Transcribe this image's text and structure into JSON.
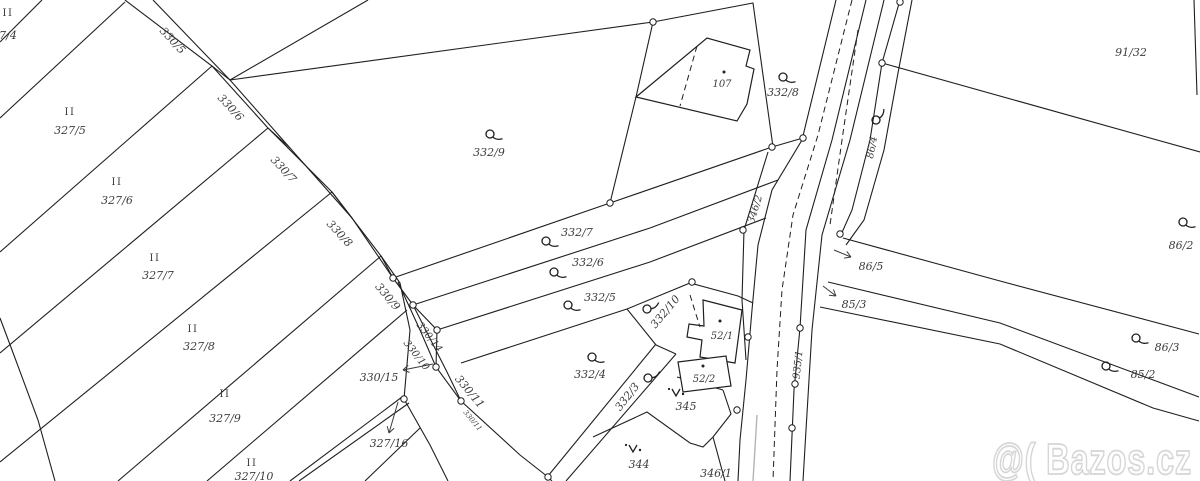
{
  "watermark": {
    "text": "@( Bazos.cz"
  },
  "map": {
    "bg": "#ffffff",
    "line_color": "#1f1f1f",
    "label_color": "#3c3c3c",
    "gray_line_color": "#b3b3b3",
    "watermark_color": "#d6d6d6",
    "lines": [
      [
        [
          42,
          0
        ],
        [
          0,
          42
        ]
      ],
      [
        [
          0,
          118
        ],
        [
          125,
          2
        ]
      ],
      [
        [
          0,
          252
        ],
        [
          212,
          66
        ]
      ],
      [
        [
          0,
          353
        ],
        [
          268,
          128
        ]
      ],
      [
        [
          0,
          462
        ],
        [
          332,
          192
        ]
      ],
      [
        [
          118,
          481
        ],
        [
          381,
          256
        ]
      ],
      [
        [
          207,
          481
        ],
        [
          407,
          310
        ]
      ],
      [
        [
          290,
          481
        ],
        [
          402,
          397
        ]
      ],
      [
        [
          299,
          481
        ],
        [
          409,
          403
        ]
      ],
      [
        [
          365,
          481
        ],
        [
          420,
          428
        ]
      ],
      [
        [
          0,
          318
        ],
        [
          12,
          350
        ],
        [
          38,
          420
        ],
        [
          55,
          481
        ]
      ],
      [
        [
          125,
          0
        ],
        [
          212,
          66
        ],
        [
          268,
          128
        ],
        [
          332,
          192
        ],
        [
          381,
          256
        ],
        [
          400,
          283
        ],
        [
          410,
          330
        ],
        [
          404,
          399
        ],
        [
          430,
          445
        ],
        [
          448,
          481
        ]
      ],
      [
        [
          153,
          0
        ],
        [
          230,
          80
        ],
        [
          290,
          148
        ],
        [
          352,
          218
        ],
        [
          393,
          278
        ],
        [
          413,
          305
        ],
        [
          437,
          330
        ],
        [
          436,
          367
        ],
        [
          461,
          401
        ],
        [
          520,
          455
        ],
        [
          548,
          477
        ],
        [
          552,
          481
        ]
      ],
      [
        [
          212,
          66
        ],
        [
          230,
          80
        ]
      ],
      [
        [
          268,
          128
        ],
        [
          290,
          148
        ]
      ],
      [
        [
          332,
          192
        ],
        [
          352,
          218
        ]
      ],
      [
        [
          381,
          256
        ],
        [
          393,
          278
        ]
      ],
      [
        [
          398,
          282
        ],
        [
          420,
          330
        ],
        [
          436,
          367
        ]
      ],
      [
        [
          413,
          305
        ],
        [
          447,
          372
        ],
        [
          461,
          401
        ]
      ],
      [
        [
          230,
          80
        ],
        [
          368,
          0
        ]
      ],
      [
        [
          230,
          80
        ],
        [
          653,
          22
        ]
      ],
      [
        [
          653,
          22
        ],
        [
          753,
          3
        ],
        [
          773,
          147
        ]
      ],
      [
        [
          653,
          22
        ],
        [
          636,
          97
        ],
        [
          610,
          203
        ]
      ],
      [
        [
          393,
          278
        ],
        [
          610,
          203
        ],
        [
          772,
          147
        ],
        [
          803,
          138
        ]
      ],
      [
        [
          413,
          305
        ],
        [
          650,
          228
        ],
        [
          778,
          180
        ]
      ],
      [
        [
          437,
          330
        ],
        [
          650,
          262
        ],
        [
          766,
          218
        ]
      ],
      [
        [
          461,
          363
        ],
        [
          627,
          309
        ],
        [
          690,
          283
        ],
        [
          738,
          296
        ],
        [
          753,
          303
        ]
      ],
      [
        [
          627,
          309
        ],
        [
          656,
          345
        ]
      ],
      [
        [
          656,
          345
        ],
        [
          676,
          354
        ]
      ],
      [
        [
          548,
          476
        ],
        [
          656,
          344
        ]
      ],
      [
        [
          566,
          481
        ],
        [
          676,
          354
        ]
      ],
      [
        [
          677,
          377
        ],
        [
          723,
          390
        ]
      ],
      [
        [
          593,
          437
        ],
        [
          647,
          412
        ],
        [
          690,
          443
        ],
        [
          703,
          447
        ],
        [
          713,
          437
        ]
      ],
      [
        [
          713,
          437
        ],
        [
          725,
          481
        ]
      ],
      [
        [
          723,
          390
        ],
        [
          731,
          414
        ],
        [
          713,
          437
        ]
      ],
      [
        [
          768,
          152
        ],
        [
          744,
          230
        ],
        [
          742,
          300
        ],
        [
          746,
          360
        ]
      ],
      [
        [
          836,
          0
        ],
        [
          802,
          140
        ],
        [
          772,
          190
        ],
        [
          758,
          245
        ],
        [
          752,
          310
        ],
        [
          746,
          380
        ],
        [
          740,
          440
        ],
        [
          738,
          481
        ]
      ],
      [
        [
          866,
          0
        ],
        [
          832,
          140
        ],
        [
          806,
          230
        ],
        [
          800,
          328
        ],
        [
          794,
          390
        ],
        [
          790,
          481
        ]
      ],
      [
        [
          884,
          0
        ],
        [
          850,
          140
        ],
        [
          822,
          235
        ],
        [
          812,
          330
        ],
        [
          806,
          430
        ],
        [
          803,
          481
        ]
      ],
      [
        [
          900,
          0
        ],
        [
          882,
          63
        ],
        [
          870,
          140
        ],
        [
          852,
          210
        ],
        [
          840,
          237
        ]
      ],
      [
        [
          912,
          0
        ],
        [
          898,
          73
        ],
        [
          884,
          150
        ],
        [
          864,
          220
        ],
        [
          846,
          245
        ]
      ],
      [
        [
          882,
          63
        ],
        [
          1200,
          152
        ]
      ],
      [
        [
          1194,
          0
        ],
        [
          1197,
          95
        ]
      ],
      [
        [
          843,
          238
        ],
        [
          1000,
          281
        ],
        [
          1199,
          334
        ]
      ],
      [
        [
          828,
          282
        ],
        [
          1000,
          323
        ],
        [
          1199,
          397
        ]
      ],
      [
        [
          820,
          307
        ],
        [
          1000,
          344
        ],
        [
          1153,
          408
        ],
        [
          1199,
          421
        ]
      ]
    ],
    "dashed": [
      [
        [
          852,
          0
        ],
        [
          818,
          135
        ],
        [
          793,
          215
        ],
        [
          782,
          290
        ],
        [
          777,
          370
        ],
        [
          773,
          481
        ]
      ],
      [
        [
          858,
          30
        ],
        [
          842,
          140
        ],
        [
          830,
          225
        ]
      ],
      [
        [
          690,
          295
        ],
        [
          700,
          327
        ]
      ],
      [
        [
          697,
          46
        ],
        [
          680,
          106
        ]
      ]
    ],
    "gray_lines": [
      [
        [
          757,
          415
        ],
        [
          753,
          481
        ]
      ]
    ],
    "buildings": [
      [
        [
          636,
          97
        ],
        [
          707,
          38
        ],
        [
          750,
          50
        ],
        [
          746,
          66
        ],
        [
          754,
          69
        ],
        [
          747,
          104
        ],
        [
          737,
          121
        ]
      ],
      [
        [
          703,
          300
        ],
        [
          742,
          310
        ],
        [
          735,
          363
        ],
        [
          700,
          357
        ],
        [
          702,
          340
        ],
        [
          687,
          337
        ],
        [
          689,
          324
        ],
        [
          704,
          326
        ]
      ],
      [
        [
          678,
          362
        ],
        [
          726,
          356
        ],
        [
          731,
          386
        ],
        [
          683,
          392
        ]
      ]
    ],
    "circles": [
      [
        653,
        22
      ],
      [
        610,
        203
      ],
      [
        772,
        147
      ],
      [
        803,
        138
      ],
      [
        692,
        282
      ],
      [
        743,
        230
      ],
      [
        393,
        278
      ],
      [
        413,
        305
      ],
      [
        437,
        330
      ],
      [
        436,
        367
      ],
      [
        404,
        399
      ],
      [
        461,
        401
      ],
      [
        548,
        477
      ],
      [
        748,
        337
      ],
      [
        737,
        410
      ],
      [
        800,
        328
      ],
      [
        795,
        384
      ],
      [
        792,
        428
      ],
      [
        882,
        63
      ],
      [
        900,
        2
      ],
      [
        840,
        234
      ]
    ],
    "dots": [
      [
        724,
        72
      ],
      [
        720,
        321
      ],
      [
        703,
        366
      ]
    ],
    "grass_symbols": [
      [
        490,
        134,
        0
      ],
      [
        783,
        77,
        0
      ],
      [
        546,
        241,
        0
      ],
      [
        554,
        272,
        0
      ],
      [
        568,
        305,
        0
      ],
      [
        592,
        357,
        0
      ],
      [
        647,
        309,
        -50
      ],
      [
        648,
        378,
        -50
      ],
      [
        876,
        120,
        -75
      ],
      [
        1183,
        222,
        0
      ],
      [
        1136,
        338,
        0
      ],
      [
        1106,
        366,
        0
      ]
    ],
    "tree_symbols": [
      [
        677,
        393
      ],
      [
        634,
        449
      ]
    ],
    "labels": [
      {
        "t": "II",
        "x": 8,
        "y": 16,
        "r": 0,
        "s": 10
      },
      {
        "t": "7/4",
        "x": 8,
        "y": 39,
        "r": 0,
        "s": 11
      },
      {
        "t": "II",
        "x": 70,
        "y": 115,
        "r": 0,
        "s": 10
      },
      {
        "t": "327/5",
        "x": 70,
        "y": 134,
        "r": 0,
        "s": 11
      },
      {
        "t": "II",
        "x": 117,
        "y": 185,
        "r": 0,
        "s": 10
      },
      {
        "t": "327/6",
        "x": 117,
        "y": 204,
        "r": 0,
        "s": 11
      },
      {
        "t": "II",
        "x": 155,
        "y": 261,
        "r": 0,
        "s": 10
      },
      {
        "t": "327/7",
        "x": 158,
        "y": 279,
        "r": 0,
        "s": 11
      },
      {
        "t": "II",
        "x": 193,
        "y": 332,
        "r": 0,
        "s": 10
      },
      {
        "t": "327/8",
        "x": 199,
        "y": 350,
        "r": 0,
        "s": 11
      },
      {
        "t": "II",
        "x": 225,
        "y": 397,
        "r": 0,
        "s": 10
      },
      {
        "t": "327/9",
        "x": 225,
        "y": 422,
        "r": 0,
        "s": 11
      },
      {
        "t": "II",
        "x": 252,
        "y": 466,
        "r": 0,
        "s": 10
      },
      {
        "t": "327/10",
        "x": 254,
        "y": 480,
        "r": 0,
        "s": 11
      },
      {
        "t": "91/32",
        "x": 1131,
        "y": 56,
        "r": 0,
        "s": 11
      },
      {
        "t": "332/9",
        "x": 489,
        "y": 156,
        "r": 0,
        "s": 11
      },
      {
        "t": "107",
        "x": 722,
        "y": 87,
        "r": 0,
        "s": 10
      },
      {
        "t": "332/8",
        "x": 783,
        "y": 96,
        "r": 0,
        "s": 11
      },
      {
        "t": "332/7",
        "x": 577,
        "y": 236,
        "r": 0,
        "s": 11
      },
      {
        "t": "332/6",
        "x": 588,
        "y": 266,
        "r": 0,
        "s": 11
      },
      {
        "t": "332/5",
        "x": 600,
        "y": 301,
        "r": 0,
        "s": 11
      },
      {
        "t": "332/4",
        "x": 590,
        "y": 378,
        "r": 0,
        "s": 11
      },
      {
        "t": "52/1",
        "x": 722,
        "y": 339,
        "r": 0,
        "s": 10
      },
      {
        "t": "52/2",
        "x": 704,
        "y": 382,
        "r": 0,
        "s": 10
      },
      {
        "t": "345",
        "x": 686,
        "y": 410,
        "r": 0,
        "s": 11
      },
      {
        "t": "344",
        "x": 639,
        "y": 468,
        "r": 0,
        "s": 11
      },
      {
        "t": "346/1",
        "x": 716,
        "y": 477,
        "r": 0,
        "s": 11
      },
      {
        "t": "86/5",
        "x": 871,
        "y": 270,
        "r": 0,
        "s": 11
      },
      {
        "t": "85/3",
        "x": 854,
        "y": 308,
        "r": 0,
        "s": 11
      },
      {
        "t": "86/3",
        "x": 1167,
        "y": 351,
        "r": 0,
        "s": 11
      },
      {
        "t": "85/2",
        "x": 1143,
        "y": 378,
        "r": 0,
        "s": 11
      },
      {
        "t": "86/2",
        "x": 1181,
        "y": 249,
        "r": 0,
        "s": 11
      },
      {
        "t": "330/15",
        "x": 379,
        "y": 381,
        "r": 0,
        "s": 11
      },
      {
        "t": "327/16",
        "x": 389,
        "y": 447,
        "r": 0,
        "s": 11
      },
      {
        "t": "330/5",
        "x": 170,
        "y": 43,
        "r": 47,
        "s": 11
      },
      {
        "t": "330/6",
        "x": 228,
        "y": 110,
        "r": 47,
        "s": 11
      },
      {
        "t": "330/7",
        "x": 281,
        "y": 172,
        "r": 47,
        "s": 11
      },
      {
        "t": "330/8",
        "x": 337,
        "y": 236,
        "r": 47,
        "s": 11
      },
      {
        "t": "330/9",
        "x": 385,
        "y": 299,
        "r": 50,
        "s": 11
      },
      {
        "t": "330/14",
        "x": 427,
        "y": 339,
        "r": 52,
        "s": 10
      },
      {
        "t": "330/10",
        "x": 414,
        "y": 357,
        "r": 52,
        "s": 10
      },
      {
        "t": "330/11",
        "x": 467,
        "y": 394,
        "r": 50,
        "s": 11
      },
      {
        "t": "330/11",
        "x": 471,
        "y": 422,
        "r": 50,
        "s": 7
      },
      {
        "t": "346/2",
        "x": 758,
        "y": 210,
        "r": -73,
        "s": 10
      },
      {
        "t": "86/4",
        "x": 875,
        "y": 148,
        "r": -79,
        "s": 10
      },
      {
        "t": "935/1",
        "x": 801,
        "y": 365,
        "r": -84,
        "s": 10
      },
      {
        "t": "332/10",
        "x": 668,
        "y": 314,
        "r": -50,
        "s": 11
      },
      {
        "t": "332/3",
        "x": 630,
        "y": 399,
        "r": -52,
        "s": 11
      }
    ],
    "arrows": [
      [
        [
          433,
          364
        ],
        [
          403,
          370
        ]
      ],
      [
        [
          398,
          402
        ],
        [
          389,
          433
        ]
      ],
      [
        [
          834,
          250
        ],
        [
          851,
          257
        ]
      ],
      [
        [
          823,
          286
        ],
        [
          836,
          296
        ]
      ]
    ]
  }
}
